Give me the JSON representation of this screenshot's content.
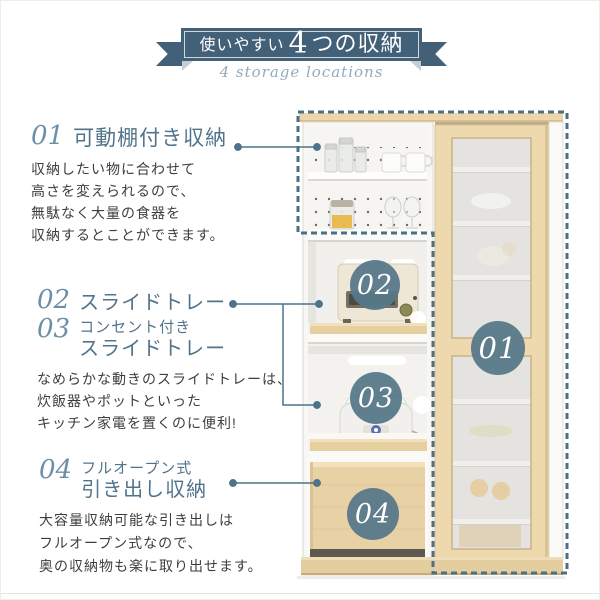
{
  "banner": {
    "title_prefix": "使いやすい",
    "title_number": "4",
    "title_suffix": "つの収納",
    "subtitle": "4 storage locations"
  },
  "groups": [
    {
      "headings": [
        {
          "number": "01",
          "lines": [
            "可動棚付き収納"
          ]
        }
      ],
      "body": [
        "収納したい物に合わせて",
        "高さを変えられるので、",
        "無駄なく大量の食器を",
        "収納するとことができます。"
      ]
    },
    {
      "headings": [
        {
          "number": "02",
          "lines": [
            "スライドトレー"
          ]
        },
        {
          "number": "03",
          "lines": [
            "コンセント付き",
            "スライドトレー"
          ]
        }
      ],
      "body": [
        "なめらかな動きのスライドトレーは、",
        "炊飯器やポットといった",
        "キッチン家電を置くのに便利!"
      ]
    },
    {
      "headings": [
        {
          "number": "04",
          "lines": [
            "フルオープン式",
            "引き出し収納"
          ]
        }
      ],
      "body": [
        "大容量収納可能な引き出しは",
        "フルオープン式なので、",
        "奥の収納物も楽に取り出せます。"
      ]
    }
  ],
  "figure": {
    "badges": [
      {
        "label": "01"
      },
      {
        "label": "02"
      },
      {
        "label": "03"
      },
      {
        "label": "04"
      }
    ]
  },
  "colors": {
    "ribbon": "#436079",
    "accent_line": "#4c7389",
    "badge": "#577889",
    "section_number": "#6d8fa5",
    "section_title": "#52748b",
    "body_text": "#3e3e3e",
    "wood": "#ead4a8",
    "glass": "#e4e3df"
  }
}
